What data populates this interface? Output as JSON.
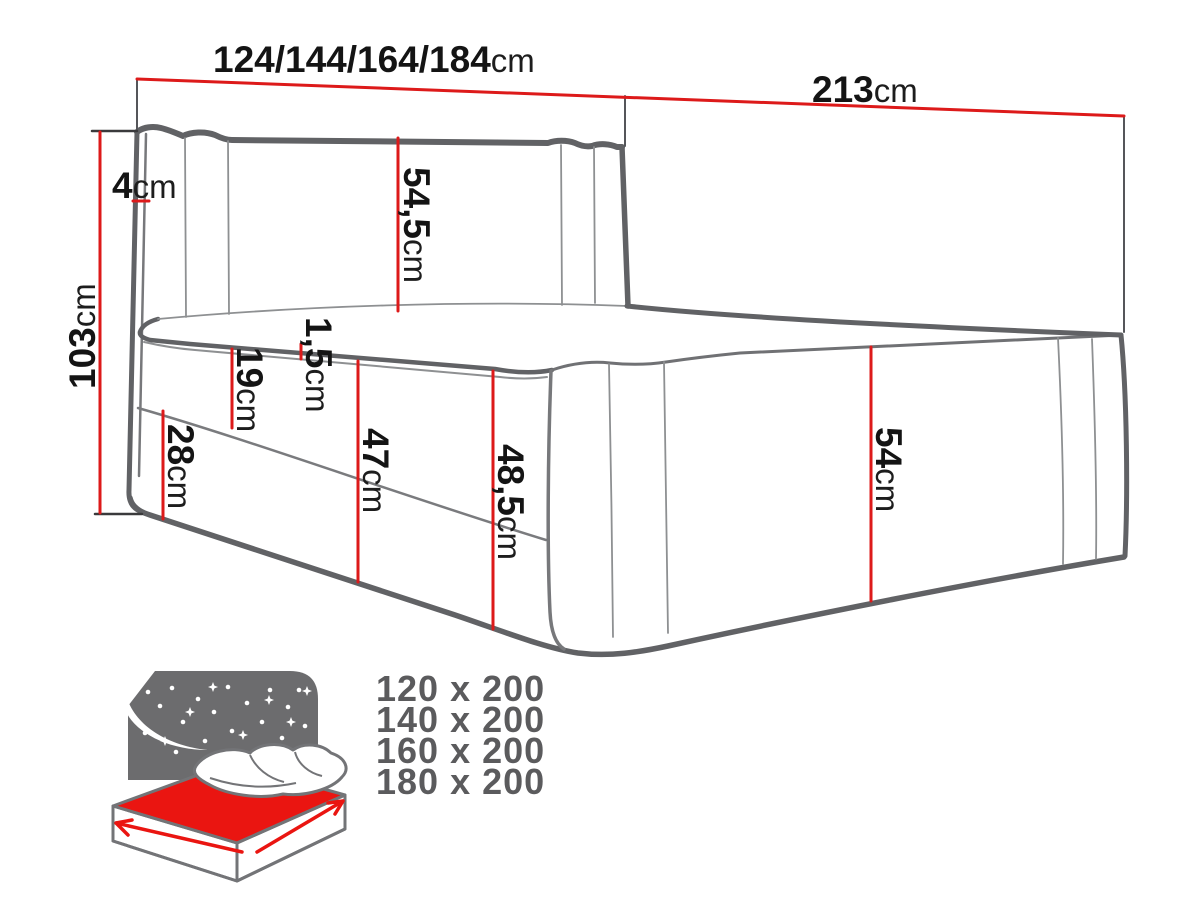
{
  "dimension_labels": {
    "width": {
      "num": "124/144/164/184",
      "unit": "cm"
    },
    "length": {
      "num": "213",
      "unit": "cm"
    },
    "height": {
      "num": "103",
      "unit": "cm"
    },
    "headboard_thickness": {
      "num": "4",
      "unit": "cm"
    },
    "headboard_panel": {
      "num": "54,5",
      "unit": "cm"
    },
    "topper_edge": {
      "num": "1,5",
      "unit": "cm"
    },
    "mattress": {
      "num": "19",
      "unit": "cm"
    },
    "base": {
      "num": "28",
      "unit": "cm"
    },
    "front_47": {
      "num": "47",
      "unit": "cm"
    },
    "front_48_5": {
      "num": "48,5",
      "unit": "cm"
    },
    "side_54": {
      "num": "54",
      "unit": "cm"
    }
  },
  "available_sizes": [
    "120 x 200",
    "140 x 200",
    "160 x 200",
    "180 x 200"
  ],
  "icons": {
    "bed_icon": "bed-with-starry-sky-icon",
    "moon_icon": "crescent-moon-icon",
    "width_arrow": "width-direction-arrow",
    "length_arrow": "length-direction-arrow"
  },
  "colors": {
    "dimension_red": "#dd1a1a",
    "outline_gray": "#616265",
    "seam_gray": "#8e9092",
    "label_black": "#141414",
    "icon_sky_gray": "#6c6c6e",
    "icon_red": "#ea1511",
    "sizes_text_gray": "#5b5b5d"
  }
}
